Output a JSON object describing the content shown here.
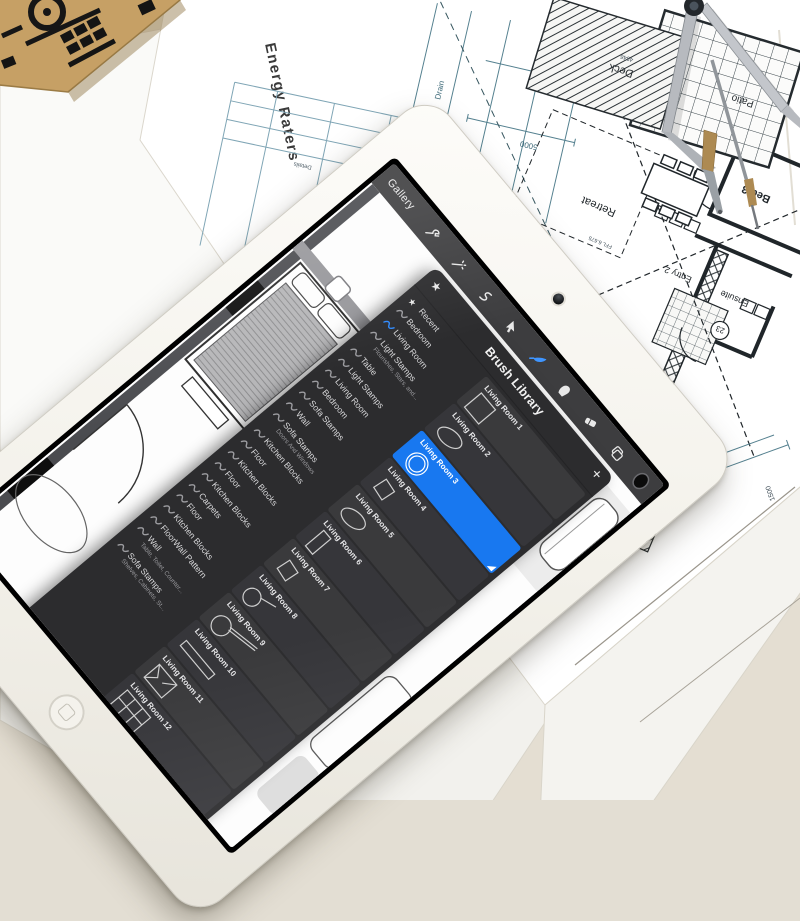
{
  "colors": {
    "accent_blue": "#1878f0",
    "panel_bg": "#2c2c2e",
    "toolbar_bg": "#3d3d3f",
    "blueprint_ink": "#252b2f",
    "blueprint_teal": "#4f7a8d",
    "wood": "#c6a065"
  },
  "tablet": {
    "toolbar": {
      "gallery": "Gallery",
      "left_icons": [
        "wrench-icon",
        "magic-wand-icon",
        "selection-icon",
        "transform-arrow-icon"
      ],
      "right_icons": [
        "paint-brush-icon",
        "smudge-icon",
        "eraser-icon",
        "layers-icon",
        "color-swatch-icon"
      ]
    },
    "brush_library": {
      "title": "Brush Library",
      "add_button": "+",
      "recent_icon": "★",
      "categories": [
        {
          "label": "Recent",
          "icon": "star",
          "selected": false
        },
        {
          "label": "Bedroom",
          "icon": "squiggle",
          "selected": false
        },
        {
          "label": "Living Room",
          "icon": "squiggle",
          "selected": true
        },
        {
          "label": "Light Stamps",
          "icon": "squiggle",
          "selected": false,
          "subtitle": "Flourishes, Stars, and..."
        },
        {
          "label": "Table",
          "icon": "squiggle",
          "selected": false
        },
        {
          "label": "Light Stamps",
          "icon": "squiggle",
          "selected": false
        },
        {
          "label": "Living Room",
          "icon": "squiggle",
          "selected": false
        },
        {
          "label": "Bedroom",
          "icon": "squiggle",
          "selected": false
        },
        {
          "label": "Sofa Stamps",
          "icon": "squiggle",
          "selected": false
        },
        {
          "label": "Wall",
          "icon": "squiggle",
          "selected": false
        },
        {
          "label": "Sofa Stamps",
          "icon": "squiggle",
          "selected": false,
          "subtitle": "Doors And Windows"
        },
        {
          "label": "Kitchen Blocks",
          "icon": "squiggle",
          "selected": false
        },
        {
          "label": "Floor",
          "icon": "squiggle",
          "selected": false
        },
        {
          "label": "Kitchen Blocks",
          "icon": "squiggle",
          "selected": false
        },
        {
          "label": "Floor",
          "icon": "squiggle",
          "selected": false
        },
        {
          "label": "Kitchen Blocks",
          "icon": "squiggle",
          "selected": false
        },
        {
          "label": "Carpets",
          "icon": "squiggle",
          "selected": false
        },
        {
          "label": "Floor",
          "icon": "squiggle",
          "selected": false
        },
        {
          "label": "Kitchen Blocks",
          "icon": "squiggle",
          "selected": false
        },
        {
          "label": "FloorWall Pattern",
          "icon": "squiggle",
          "selected": false
        },
        {
          "label": "Wall",
          "icon": "squiggle",
          "selected": false,
          "subtitle": "Table, Toilet, Counter..."
        },
        {
          "label": "Sofa Stamps",
          "icon": "squiggle",
          "selected": false,
          "subtitle": "Shelves, Cabinets, St..."
        }
      ],
      "brushes": [
        {
          "name": "Living Room 1",
          "stamp": "square",
          "selected": false
        },
        {
          "name": "Living Room 2",
          "stamp": "ellipse",
          "selected": false
        },
        {
          "name": "Living Room 3",
          "stamp": "double-circle",
          "selected": true
        },
        {
          "name": "Living Room 4",
          "stamp": "square-small",
          "selected": false
        },
        {
          "name": "Living Room 5",
          "stamp": "ellipse",
          "selected": false
        },
        {
          "name": "Living Room 6",
          "stamp": "tall-rect",
          "selected": false
        },
        {
          "name": "Living Room 7",
          "stamp": "square-small",
          "selected": false
        },
        {
          "name": "Living Room 8",
          "stamp": "lamp",
          "selected": false
        },
        {
          "name": "Living Room 9",
          "stamp": "lamp-long",
          "selected": false
        },
        {
          "name": "Living Room 10",
          "stamp": "thin-rect",
          "selected": false
        },
        {
          "name": "Living Room 11",
          "stamp": "armchair",
          "selected": false
        },
        {
          "name": "Living Room 12",
          "stamp": "sofa",
          "selected": false
        }
      ]
    }
  },
  "blueprint": {
    "energy_raters": "Energy Raters",
    "table_header": "Details",
    "room_labels": {
      "deck_top": "Deck",
      "patio": "Patio",
      "bed3": "Bed 3",
      "ensuite": "Ensuite",
      "entry2": "Entry 2",
      "retreat": "Retreat",
      "deck_bottom": "Deck"
    },
    "annotations": {
      "deck_number": "4846",
      "circle_ref": "23",
      "dim_a": "5000",
      "dim_b": "950",
      "ffl": "FFL 6.675",
      "drain": "Drain",
      "side_dim": "1500"
    }
  },
  "scene_props": [
    "wooden-house-model",
    "drafting-compass",
    "blueprint-sheets",
    "tablet-device"
  ]
}
